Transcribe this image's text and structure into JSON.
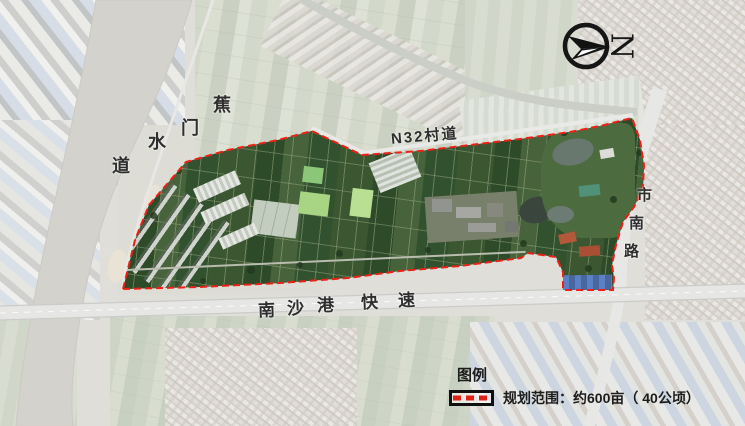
{
  "labels": {
    "river_chars": [
      "蕉",
      "门",
      "水",
      "道"
    ],
    "village_road": "N32村道",
    "expressway_chars": [
      "南",
      "沙",
      "港",
      "快",
      "速"
    ],
    "south_road_chars": [
      "市",
      "南",
      "路"
    ]
  },
  "compass": {
    "north": "N"
  },
  "legend": {
    "title": "图例",
    "boundary_label": "规划范围：约600亩（ 40公顷）"
  },
  "colors": {
    "boundary_red": "#ee2015",
    "legend_dash_red": "#e32015",
    "label_text": "#2e2e2e"
  }
}
